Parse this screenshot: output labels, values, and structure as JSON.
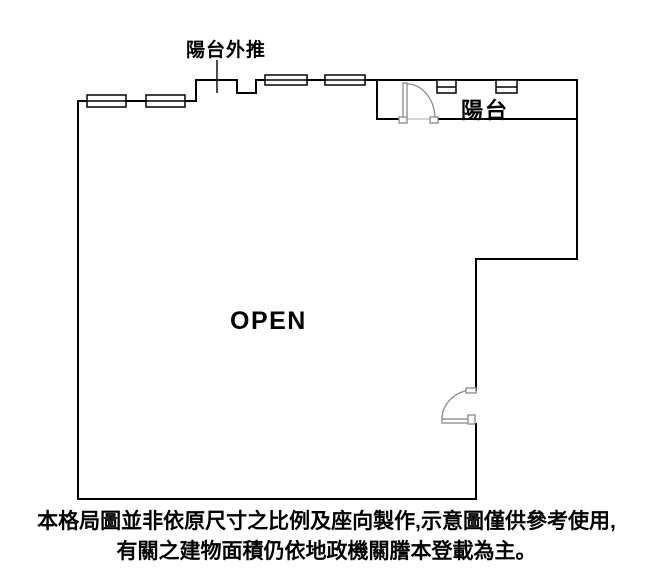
{
  "plan": {
    "annotation": {
      "balcony_pushout": "陽台外推"
    },
    "labels": {
      "balcony": "陽台",
      "room": "OPEN"
    },
    "colors": {
      "wall": "#000000",
      "window": "#000000",
      "door": "#8a8a8a",
      "threshold": "#aaaaaa",
      "background": "#ffffff",
      "text": "#000000"
    }
  },
  "disclaimer": {
    "line1": "本格局圖並非依原尺寸之比例及座向製作,示意圖僅供參考使用,",
    "line2": "有關之建物面積仍依地政機關謄本登載為主。"
  }
}
